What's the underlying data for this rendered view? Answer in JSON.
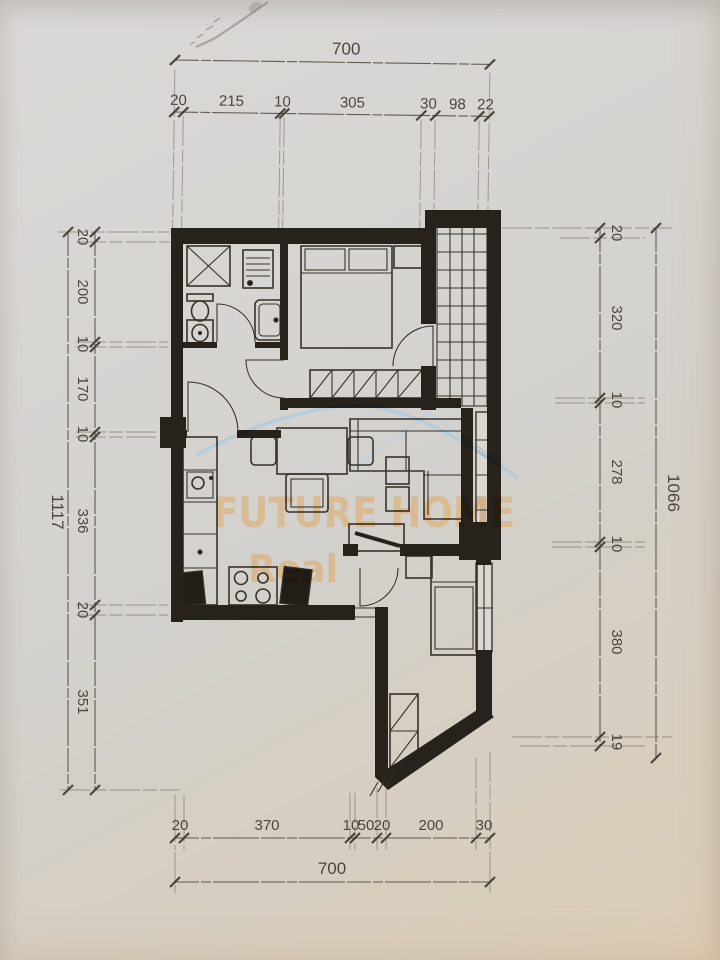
{
  "document": {
    "kind": "scanned apartment floor plan photo"
  },
  "watermark": {
    "brand": "FUTURE HOME",
    "tagline": "Real",
    "text_color": "#dfa55a",
    "swoosh_color": "#9cc6e2"
  },
  "dimensions": {
    "top": {
      "overall": "700",
      "chain": [
        "20",
        "215",
        "10",
        "305",
        "30",
        "98",
        "22"
      ]
    },
    "bottom": {
      "overall": "700",
      "chain": [
        "20",
        "370",
        "10",
        "50",
        "20",
        "200",
        "30"
      ]
    },
    "left": {
      "overall": "1117",
      "chain": [
        "20",
        "200",
        "10",
        "170",
        "10",
        "336",
        "20",
        "351"
      ]
    },
    "right": {
      "overall": "1066",
      "chain": [
        "20",
        "320",
        "10",
        "278",
        "10",
        "380",
        "19"
      ]
    }
  },
  "colors": {
    "paper": "#d6d3cf",
    "ink": "#45403a",
    "wall": "#27221c"
  }
}
